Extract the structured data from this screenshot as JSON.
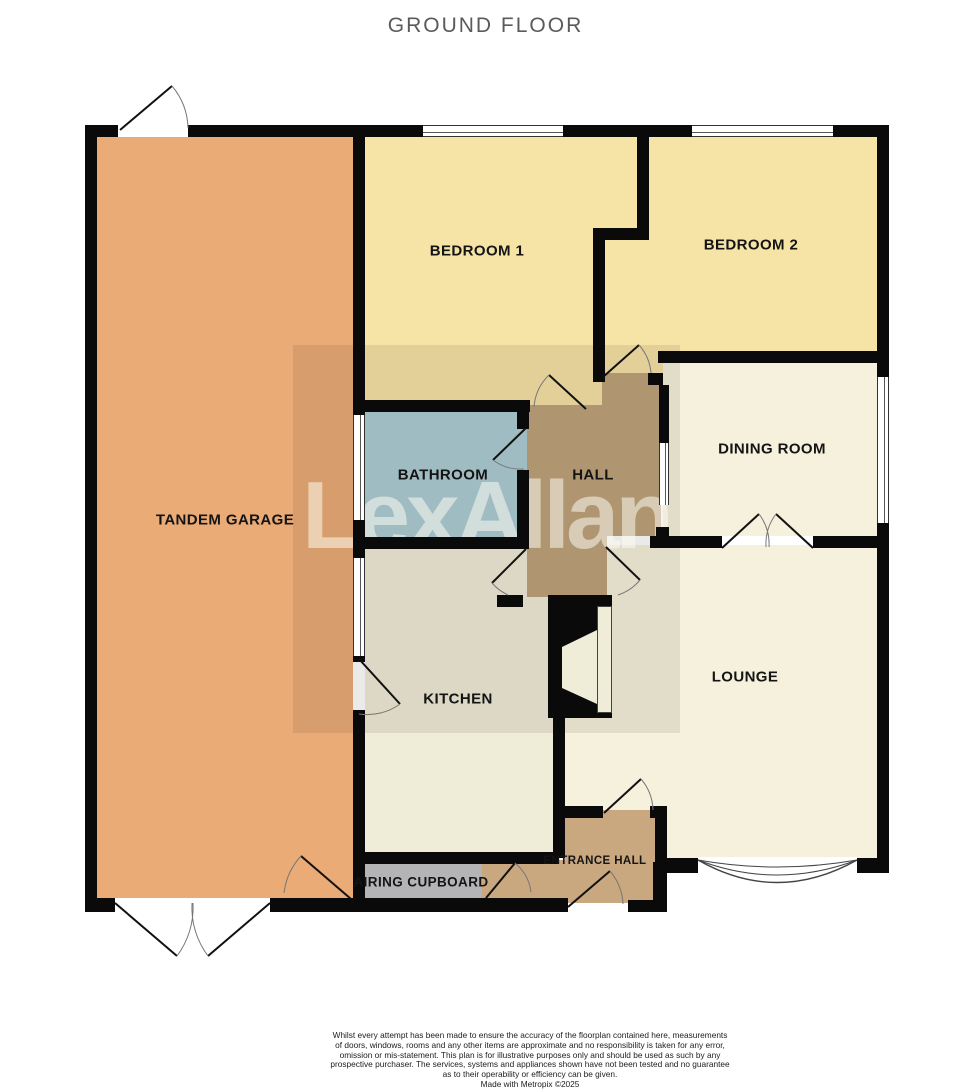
{
  "title": "GROUND FLOOR",
  "watermark": "LexAllan",
  "rooms": {
    "garage": {
      "label": "TANDEM GARAGE",
      "color": "#EAAB76"
    },
    "bedroom1": {
      "label": "BEDROOM 1",
      "color": "#F6E3A6"
    },
    "bedroom2": {
      "label": "BEDROOM 2",
      "color": "#F6E3A6"
    },
    "bathroom": {
      "label": "BATHROOM",
      "color": "#ADCDD6"
    },
    "hall": {
      "label": "HALL",
      "color": "#BEA37C"
    },
    "dining": {
      "label": "DINING ROOM",
      "color": "#F6F1DC"
    },
    "kitchen": {
      "label": "KITCHEN",
      "color": "#EFECD8"
    },
    "lounge": {
      "label": "LOUNGE",
      "color": "#F6F1DC"
    },
    "entrance": {
      "label": "ENTRANCE HALL",
      "color": "#C9A77F"
    },
    "airing": {
      "label": "AIRING CUPBOARD",
      "color": "#B4B4B6"
    }
  },
  "colors": {
    "wall": "#0a0a0a",
    "window": "#ffffff",
    "title_text": "#5b5b5b"
  },
  "footer": {
    "lines": [
      "Whilst every attempt has been made to ensure the accuracy of the floorplan contained here, measurements",
      "of doors, windows, rooms and any other items are approximate and no responsibility is taken for any error,",
      "omission or mis-statement. This plan is for illustrative purposes only and should be used as such by any",
      "prospective purchaser. The services, systems and appliances shown have not been tested and no guarantee",
      "as to their operability or efficiency can be given.",
      "Made with Metropix ©2025"
    ]
  }
}
